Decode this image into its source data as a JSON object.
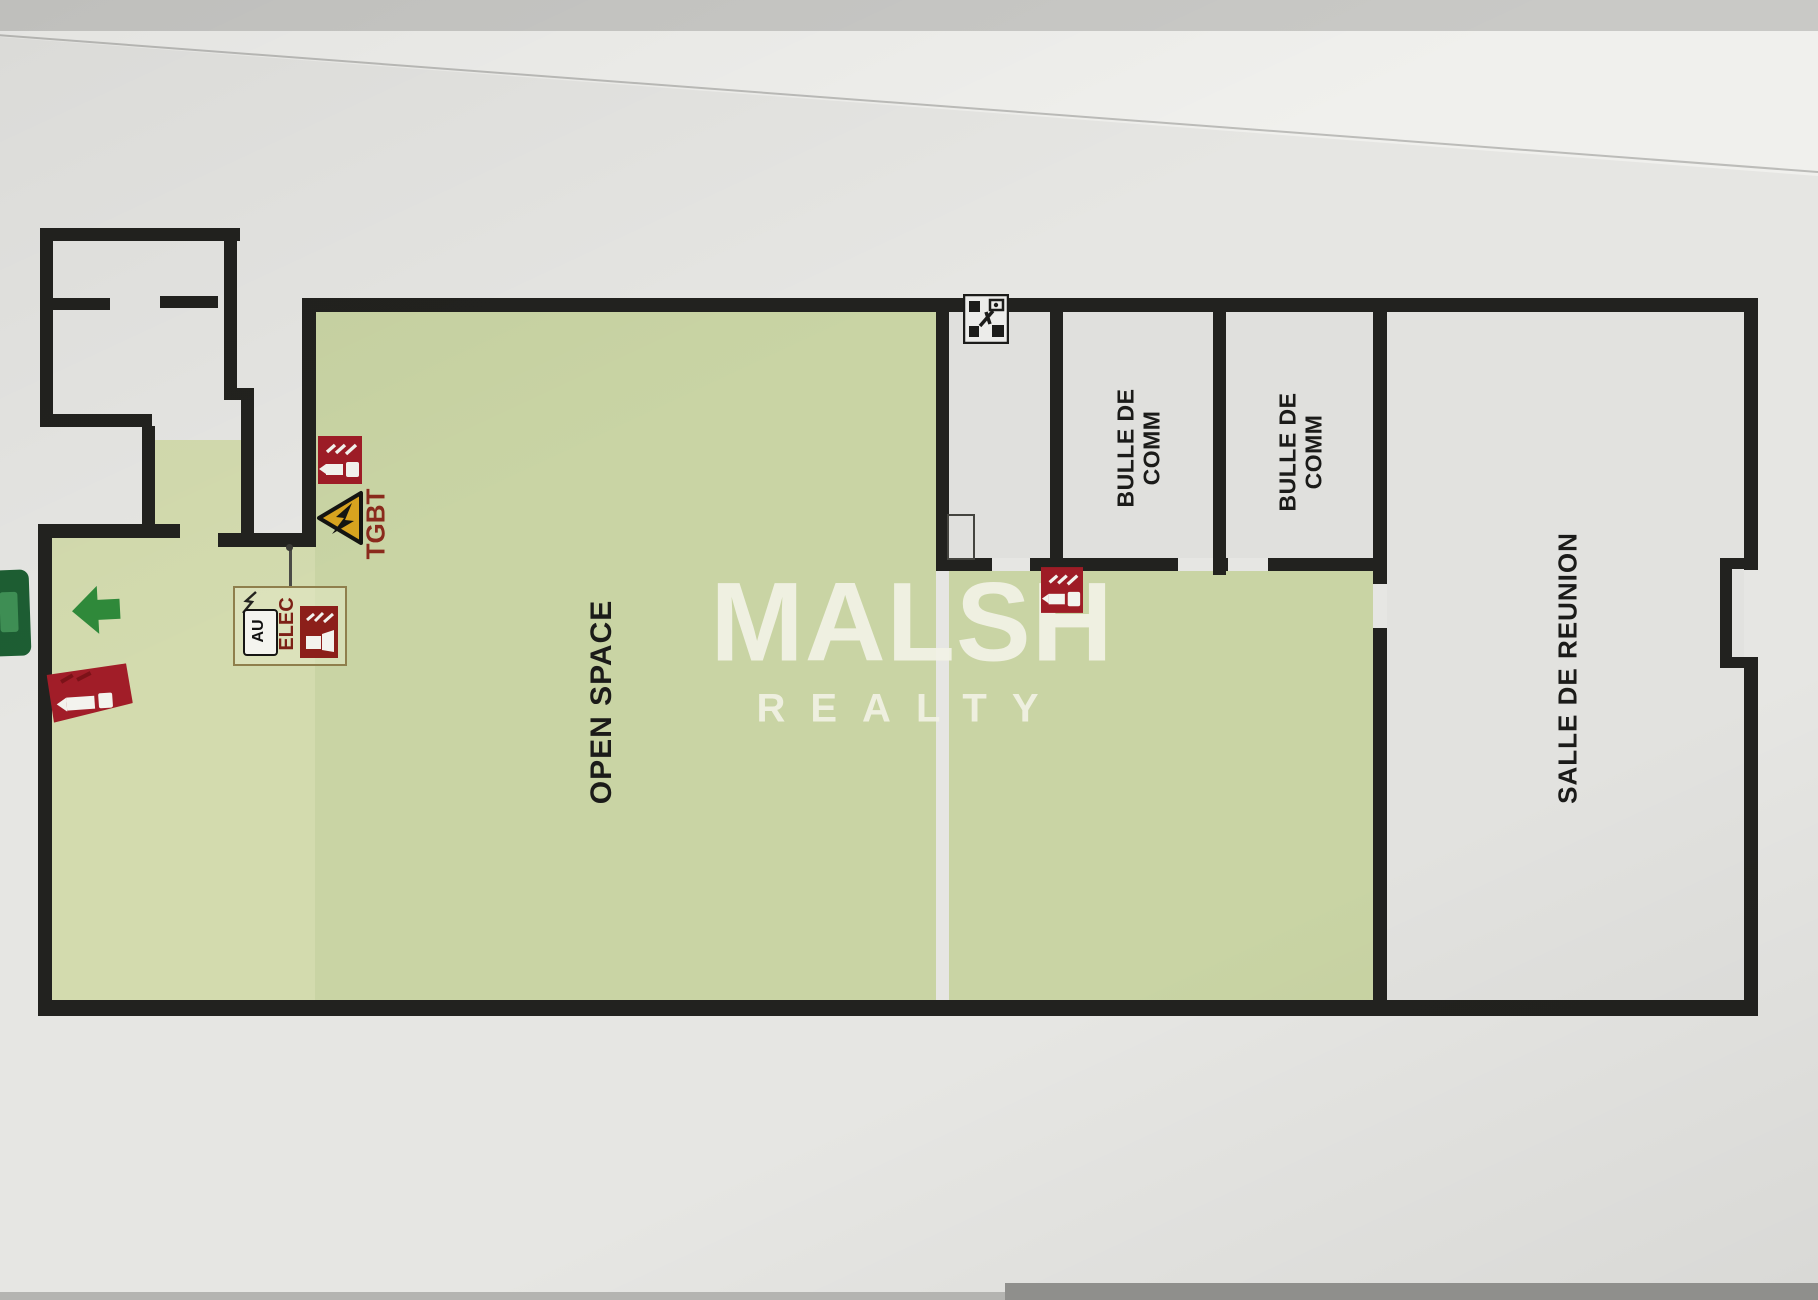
{
  "watermark": {
    "title": "MALSH",
    "subtitle": "REALTY"
  },
  "rooms": {
    "open_space": {
      "label": "OPEN SPACE"
    },
    "bulle_comm_1": {
      "label_line1": "BULLE DE",
      "label_line2": "COMM"
    },
    "bulle_comm_2": {
      "label_line1": "BULLE DE",
      "label_line2": "COMM"
    },
    "salle_reunion": {
      "label": "SALLE DE REUNION"
    }
  },
  "annotations": {
    "tgbt": {
      "label": "TGBT"
    },
    "elec_legend": {
      "au_label": "AU",
      "elec_label": "ELEC"
    }
  },
  "icons": {
    "fire_extinguisher": "fire-extinguisher-sign",
    "manual_call_point": "manual-call-point-sign",
    "electrical_hazard": "electrical-hazard-triangle",
    "exit_arrow": "exit-direction-arrow",
    "exit_sign": "emergency-exit-sign",
    "equipment": "equipment-pictogram"
  },
  "colors": {
    "wall": "#22221f",
    "green_zone": "#c9d4a4",
    "extinguisher_red": "#9e1c26",
    "warning_yellow": "#d9a41f",
    "exit_green": "#2f8a3a",
    "tgbt_text": "#8a2a1c",
    "elec_text": "#7c2015",
    "watermark": "#f2f2e6"
  }
}
